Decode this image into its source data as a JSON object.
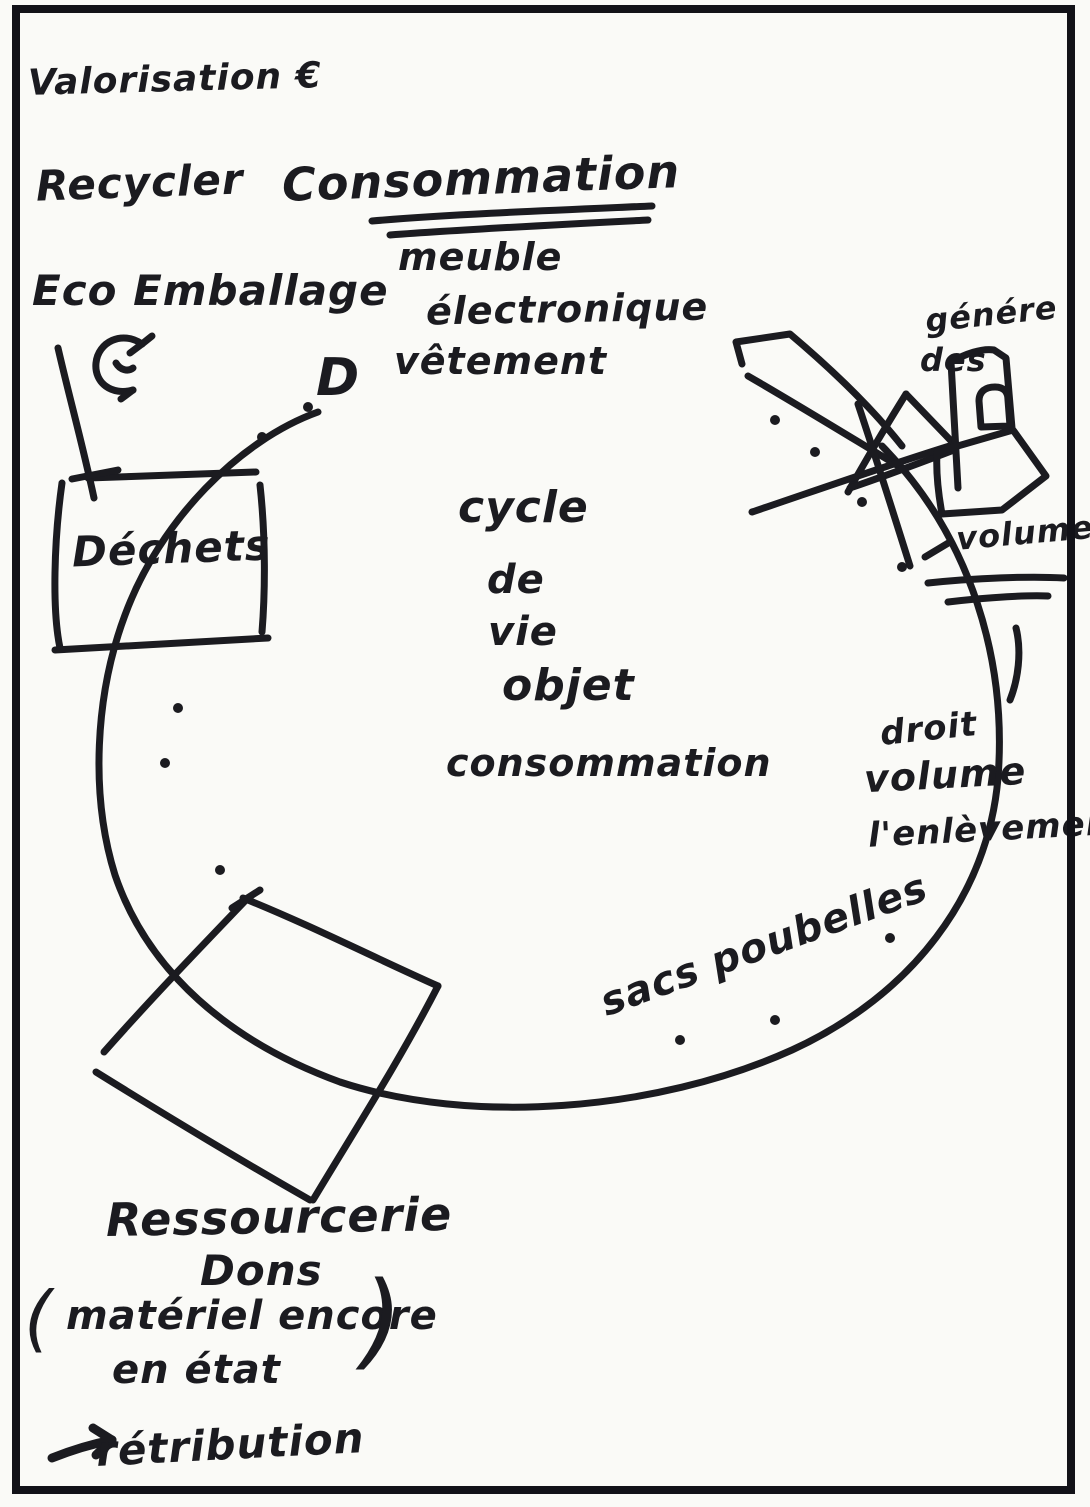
{
  "sketch": {
    "top_left": {
      "valorisation": "Valorisation €",
      "recycler": "Recycler",
      "eco_emballage": "Eco Emballage"
    },
    "top": {
      "consommation": "Consommation",
      "items": [
        "meuble",
        "électronique",
        "vêtement"
      ],
      "d_label": "D"
    },
    "left": {
      "dechets": "Déchets"
    },
    "center": {
      "lines": [
        "cycle",
        "de",
        "vie",
        "objet",
        "consommation"
      ]
    },
    "right": {
      "genere": "génére",
      "des": "des",
      "volumes": "volumes",
      "droit": "droit",
      "volume": "volume",
      "enlevement": "l'enlèvement"
    },
    "bottom": {
      "sacs_poubelles": "sacs poubelles",
      "ressourcerie": "Ressourcerie",
      "dons": "Dons",
      "paren_open": "(",
      "materiel": "matériel encore",
      "en_etat": "en état",
      "paren_close": ")",
      "retribution": "rétribution"
    }
  },
  "icons": {
    "recycle": "circular-recycle-arrow",
    "arrow_right": "hand-drawn-right-arrow"
  },
  "colors": {
    "ink": "#1b1b20",
    "paper": "#fafaf7",
    "frame": "#121218"
  }
}
